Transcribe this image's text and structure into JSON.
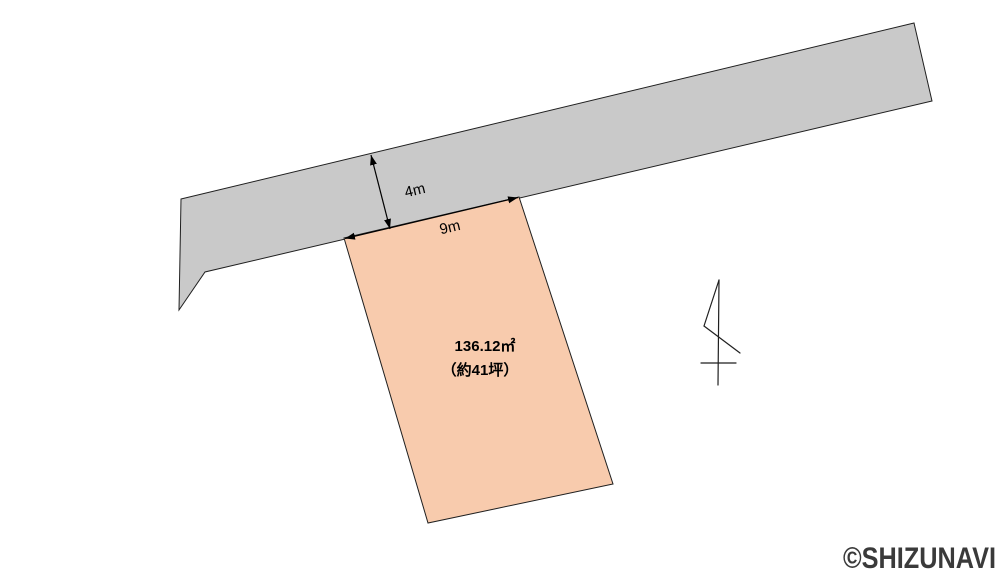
{
  "diagram": {
    "kind": "land-plot-site-plan",
    "labels": {
      "road_width": "4m",
      "frontage": "9m"
    },
    "plot": {
      "area_sqm": "136.12㎡",
      "area_tsubo": "（約41坪）"
    },
    "watermark": "©SHIZUNAVI",
    "icons": {
      "north": "north-arrow-icon"
    },
    "colors": {
      "background": "#ffffff",
      "road_fill": "#c9c9c9",
      "plot_fill": "#f8cbad",
      "outline": "#1f1f1f",
      "dimension_text": "#000000",
      "watermark_text": "#3a3a3a"
    }
  }
}
